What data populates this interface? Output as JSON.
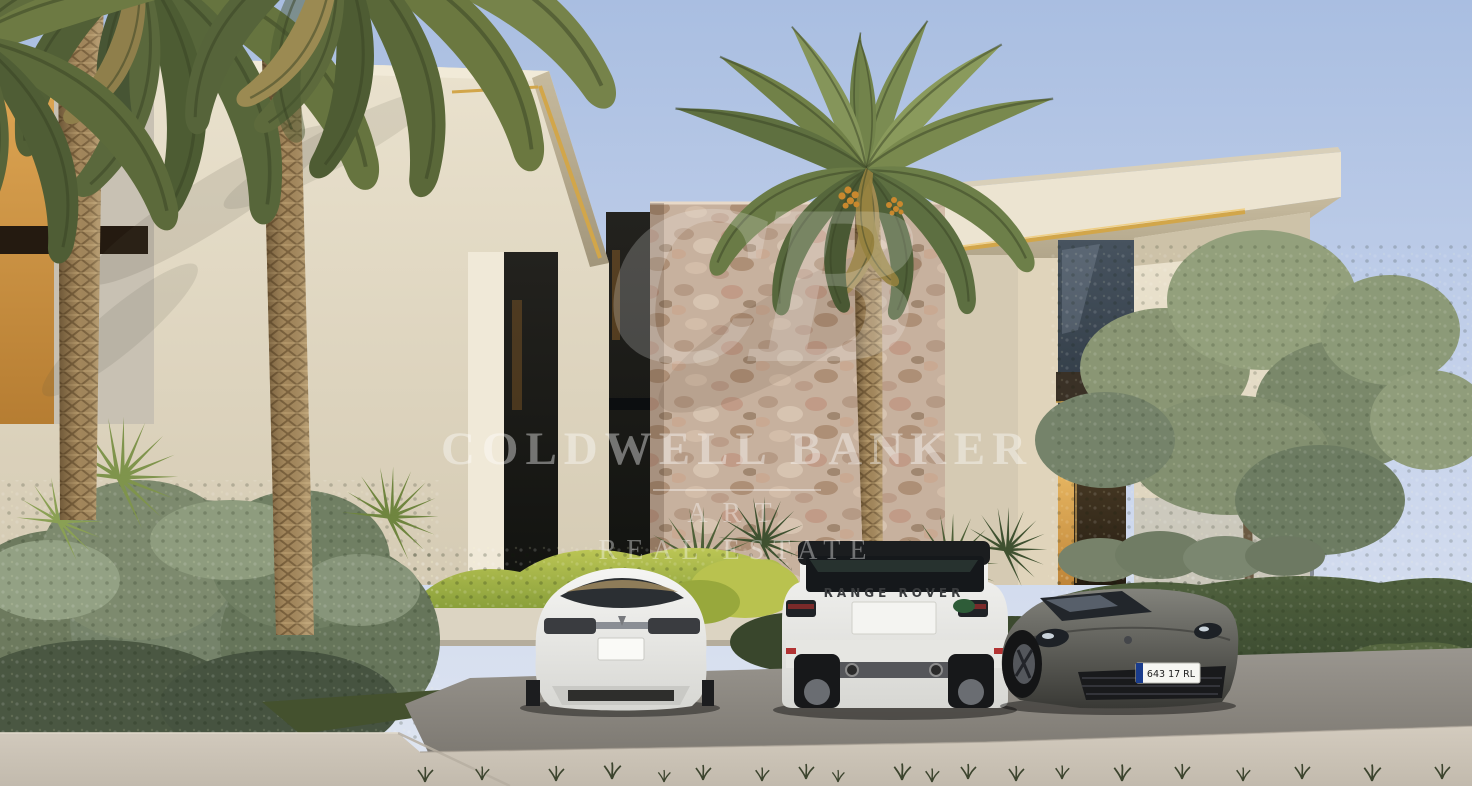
{
  "scene": {
    "setting": "modern-luxury-villa-exterior-daytime",
    "elements": [
      "palm-trees",
      "stone-feature-wall",
      "gold-roof-trim",
      "olive-tree",
      "hedges",
      "driveway"
    ]
  },
  "watermark": {
    "monogram": "CB",
    "brand": "COLDWELL BANKER",
    "division": "ART",
    "division2": "REAL ESTATE",
    "color": "#ffffff"
  },
  "vehicles": {
    "suv_badge": "RANGE ROVER",
    "sports_car_plate": "643 17 RL"
  },
  "colors": {
    "sky_top": "#aabfe2",
    "sky_bottom": "#dfe5f1",
    "facade": "#e6ddc8",
    "gold_trim": "#d2a64a",
    "stone": "#c7b19e",
    "foliage": "#5c6e42",
    "pavement": "#c8c0b3",
    "parking_pad": "#8e8a83"
  }
}
